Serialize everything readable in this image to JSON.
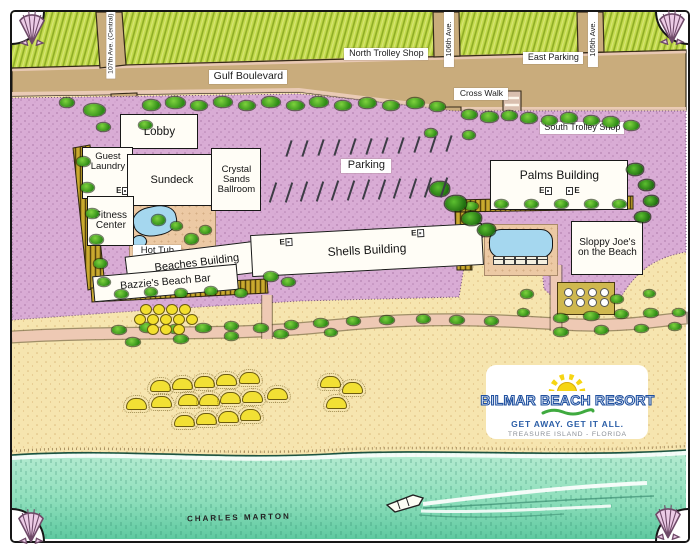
{
  "streets": {
    "ave107": "107th Ave. (Central)",
    "gulf": "Gulf Boulevard",
    "ave106": "106th Ave.",
    "ave105": "105th Ave.",
    "crosswalk": "Cross Walk"
  },
  "places": {
    "north_trolley": "North Trolley Shop",
    "east_parking": "East Parking",
    "south_trolley": "South Trolley Shop",
    "parking": "Parking"
  },
  "buildings": {
    "lobby": "Lobby",
    "guest_laundry": "Guest Laundry",
    "sundeck": "Sundeck",
    "crystal_sands": "Crystal Sands Ballroom",
    "fitness": "Fitness Center",
    "hot_tub": "Hot Tub",
    "beaches": "Beaches Building",
    "bazzies": "Bazzie's Beach Bar",
    "shells": "Shells Building",
    "palms": "Palms Building",
    "sloppy_joes": "Sloppy Joe's on the Beach"
  },
  "elevator_label": "E",
  "logo": {
    "name": "BILMAR BEACH RESORT",
    "tagline": "GET AWAY. GET IT ALL.",
    "location": "TREASURE ISLAND - FLORIDA"
  },
  "signature": "CHARLES MARTON",
  "colors": {
    "grass": "#c3da4d",
    "road": "#c9ac7c",
    "parking_lot": "#d9acd5",
    "sand": "#f6e5af",
    "water": "#7fd6ae",
    "pool": "#a5d7ef",
    "logo_blue": "#1f4f9e",
    "sun_yellow": "#f6d513",
    "wave_green": "#3faa3f",
    "shell_pink": "#eccbe6"
  }
}
